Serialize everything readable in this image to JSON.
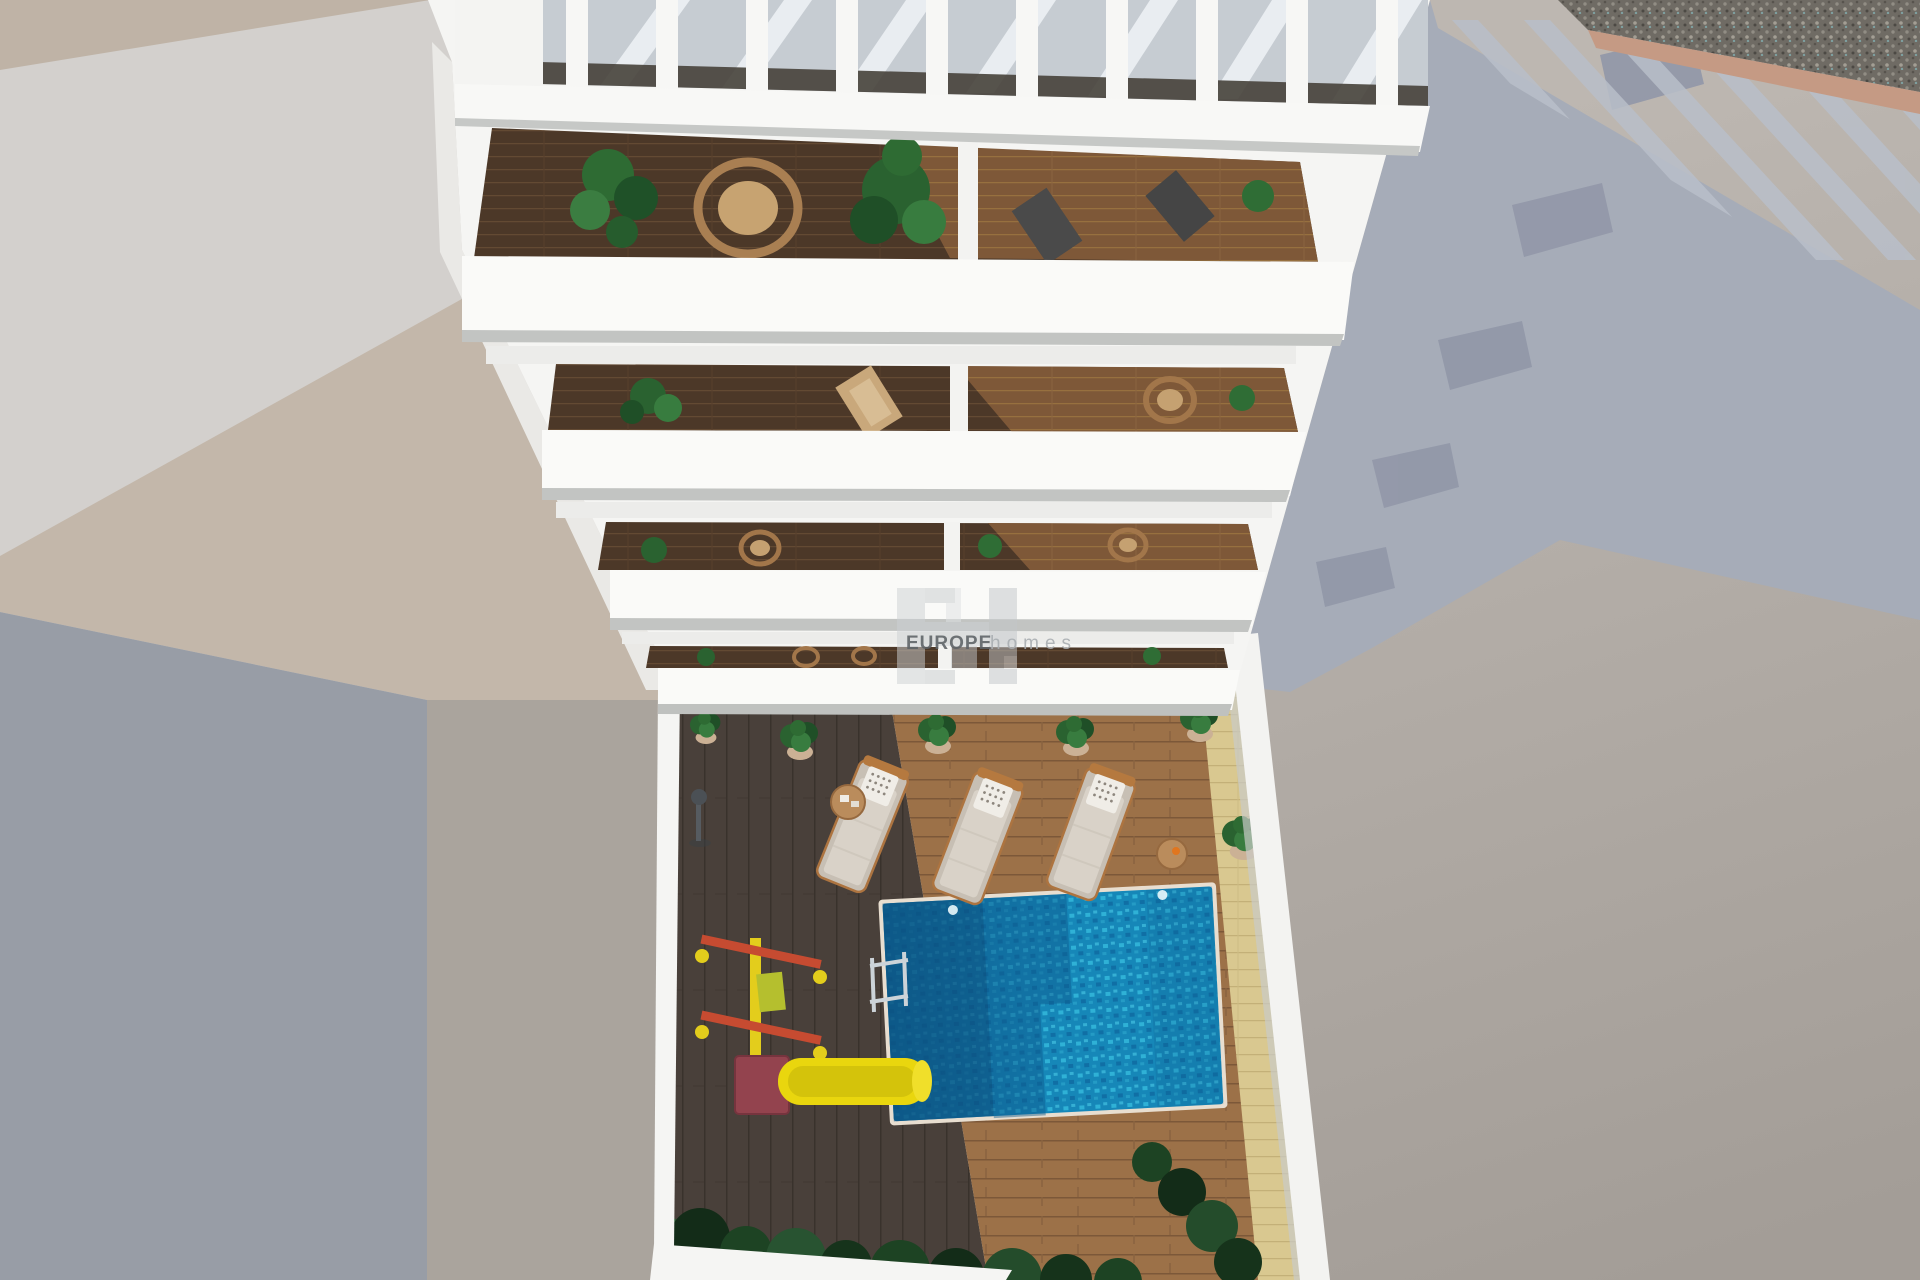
{
  "watermark": {
    "brand_bold": "EUROPE",
    "brand_light": "homes",
    "monogram": "EH"
  },
  "scene": {
    "type": "aerial top-down 3D architectural render",
    "subject": "White apartment building with tiered balconies above a courtyard pool terrace",
    "building": {
      "roof": "white slatted pergola casting diagonal shadows",
      "balcony_floors": 4,
      "balcony_items": [
        "potted palms",
        "round wicker chairs",
        "dark sling chairs",
        "tan lounge chair",
        "dark wood decking",
        "white divider walls"
      ]
    },
    "courtyard": {
      "items": [
        "turquoise swimming pool",
        "pool ladder",
        "three sun loungers with dotted pillows",
        "round side tables",
        "potted plants",
        "yellow kids slide",
        "red climbing frame",
        "outdoor shower",
        "hedge shrubs",
        "dark wood deck",
        "light wood deck",
        "sand colored deck strip"
      ]
    },
    "surroundings": [
      "light concrete pavement",
      "tan neighbouring rooftop corner",
      "gravel strip with salmon curb",
      "large cool cast shadow with stepped balcony silhouettes"
    ]
  },
  "colors": {
    "building_white": "#f5f5f3",
    "band_white": "#fafaf8",
    "cast_shadow": "#a6acb8",
    "ground_left_shadow": "#989da6",
    "ground_light": "#d3d0cd",
    "beige_paving": "#c3b7aa",
    "warm_strip": "#aaa49d",
    "tan_roof": "#bfb3a6",
    "pool_shadow": "#0b4c7c",
    "slide_yellow": "#e9d60e",
    "playground_red": "#c64b31",
    "slide_box_red": "#93434e",
    "lounger_cushion": "#d9d2c8",
    "plant_green": "#2e6b33",
    "deck_dark": "#49403a",
    "deck_light": "#9c7148",
    "deck_sand": "#d9c890"
  }
}
